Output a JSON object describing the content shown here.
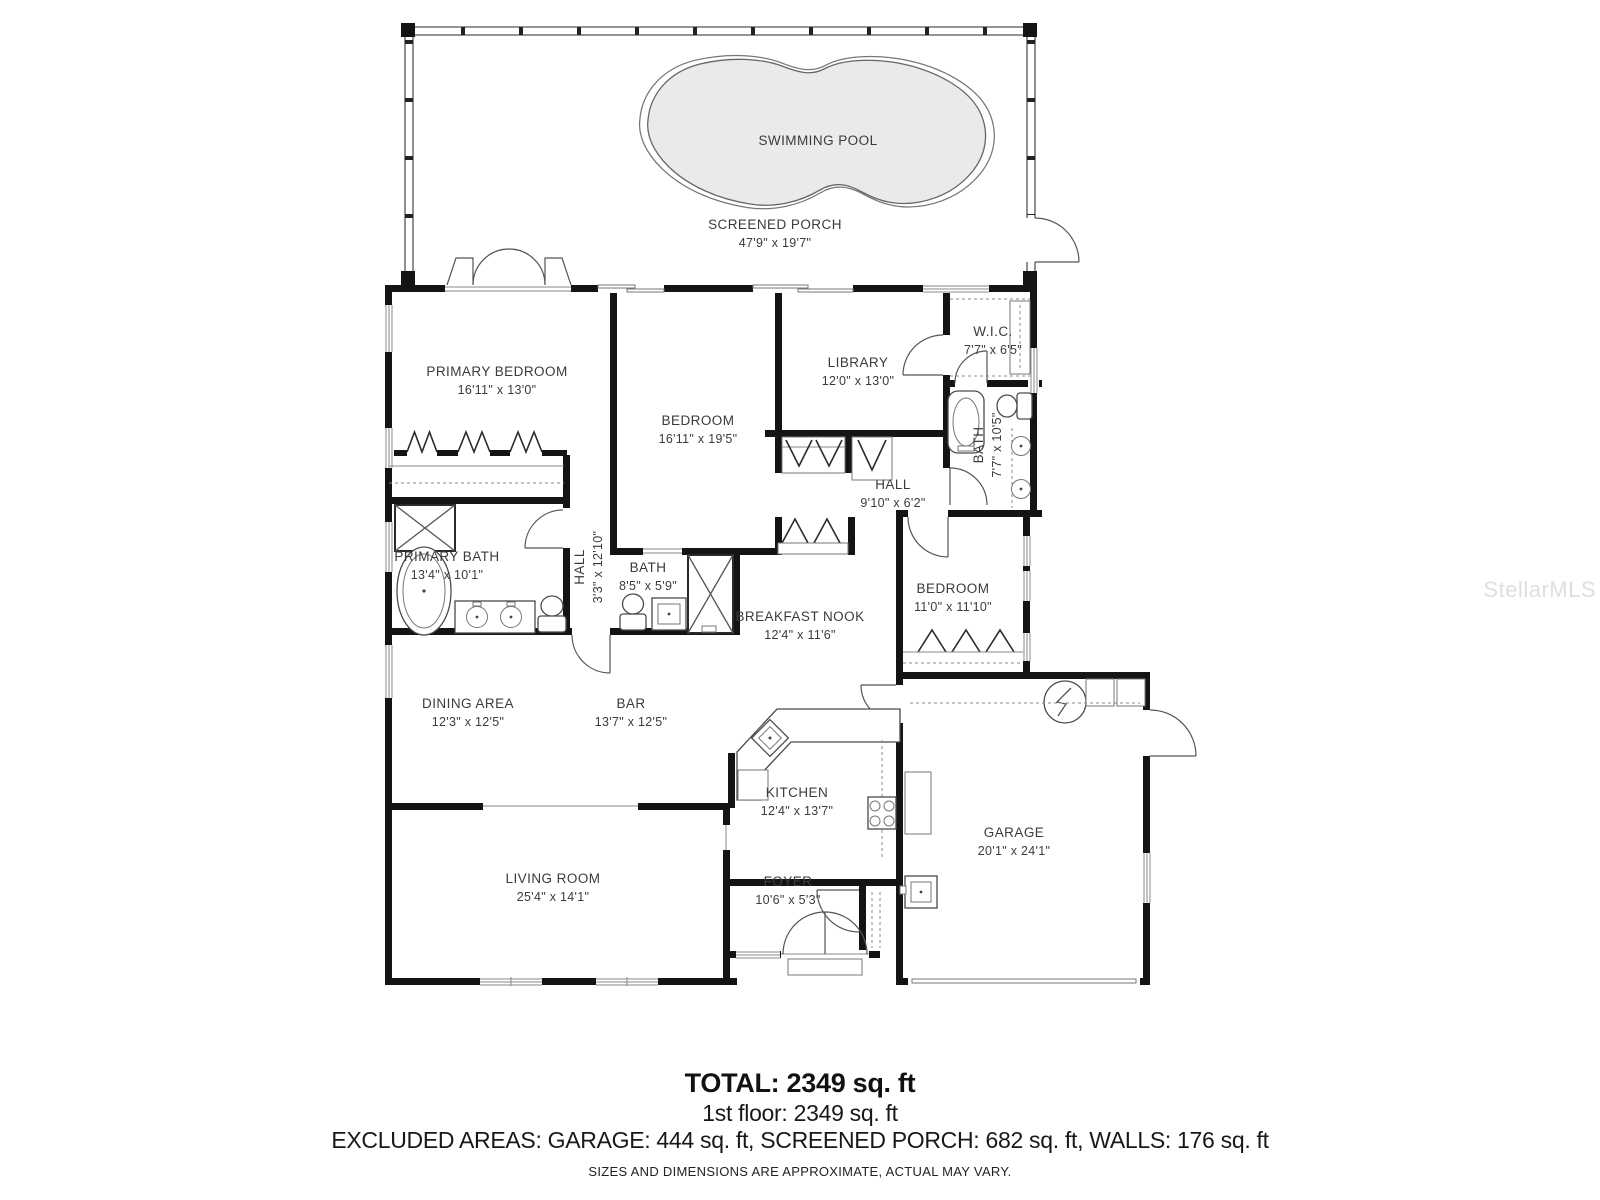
{
  "colors": {
    "wall": "#141414",
    "pool_fill": "#e9eaeb",
    "line": "#555555",
    "watermark_text": "#dedede"
  },
  "watermark": "StellarMLS",
  "rooms": {
    "swimming_pool": {
      "name": "SWIMMING POOL",
      "dims": ""
    },
    "screened_porch": {
      "name": "SCREENED PORCH",
      "dims": "47'9\" x 19'7\""
    },
    "primary_bedroom": {
      "name": "PRIMARY BEDROOM",
      "dims": "16'11\" x 13'0\""
    },
    "bedroom_2": {
      "name": "BEDROOM",
      "dims": "16'11\" x 19'5\""
    },
    "library": {
      "name": "LIBRARY",
      "dims": "12'0\" x 13'0\""
    },
    "wic": {
      "name": "W.I.C.",
      "dims": "7'7\" x 6'5\""
    },
    "bath_main": {
      "name": "BATH",
      "dims": "7'7\" x 10'5\""
    },
    "hall_upper": {
      "name": "HALL",
      "dims": "9'10\" x 6'2\""
    },
    "bedroom_3": {
      "name": "BEDROOM",
      "dims": "11'0\" x 11'10\""
    },
    "primary_bath": {
      "name": "PRIMARY BATH",
      "dims": "13'4\" x 10'1\""
    },
    "hall_lower": {
      "name": "HALL",
      "dims": "3'3\" x 12'10\""
    },
    "bath_2": {
      "name": "BATH",
      "dims": "8'5\" x 5'9\""
    },
    "breakfast_nook": {
      "name": "BREAKFAST NOOK",
      "dims": "12'4\" x 11'6\""
    },
    "dining_area": {
      "name": "DINING AREA",
      "dims": "12'3\" x 12'5\""
    },
    "bar": {
      "name": "BAR",
      "dims": "13'7\" x 12'5\""
    },
    "kitchen": {
      "name": "KITCHEN",
      "dims": "12'4\" x 13'7\""
    },
    "garage": {
      "name": "GARAGE",
      "dims": "20'1\" x 24'1\""
    },
    "living_room": {
      "name": "LIVING ROOM",
      "dims": "25'4\" x 14'1\""
    },
    "foyer": {
      "name": "FOYER",
      "dims": "10'6\" x 5'3\""
    }
  },
  "footer": {
    "total": "TOTAL: 2349 sq. ft",
    "floor1": "1st floor: 2349 sq. ft",
    "excluded": "EXCLUDED AREAS: GARAGE: 444 sq. ft, SCREENED PORCH: 682 sq. ft, WALLS: 176 sq. ft",
    "disclaimer": "SIZES AND DIMENSIONS ARE APPROXIMATE, ACTUAL MAY VARY."
  }
}
